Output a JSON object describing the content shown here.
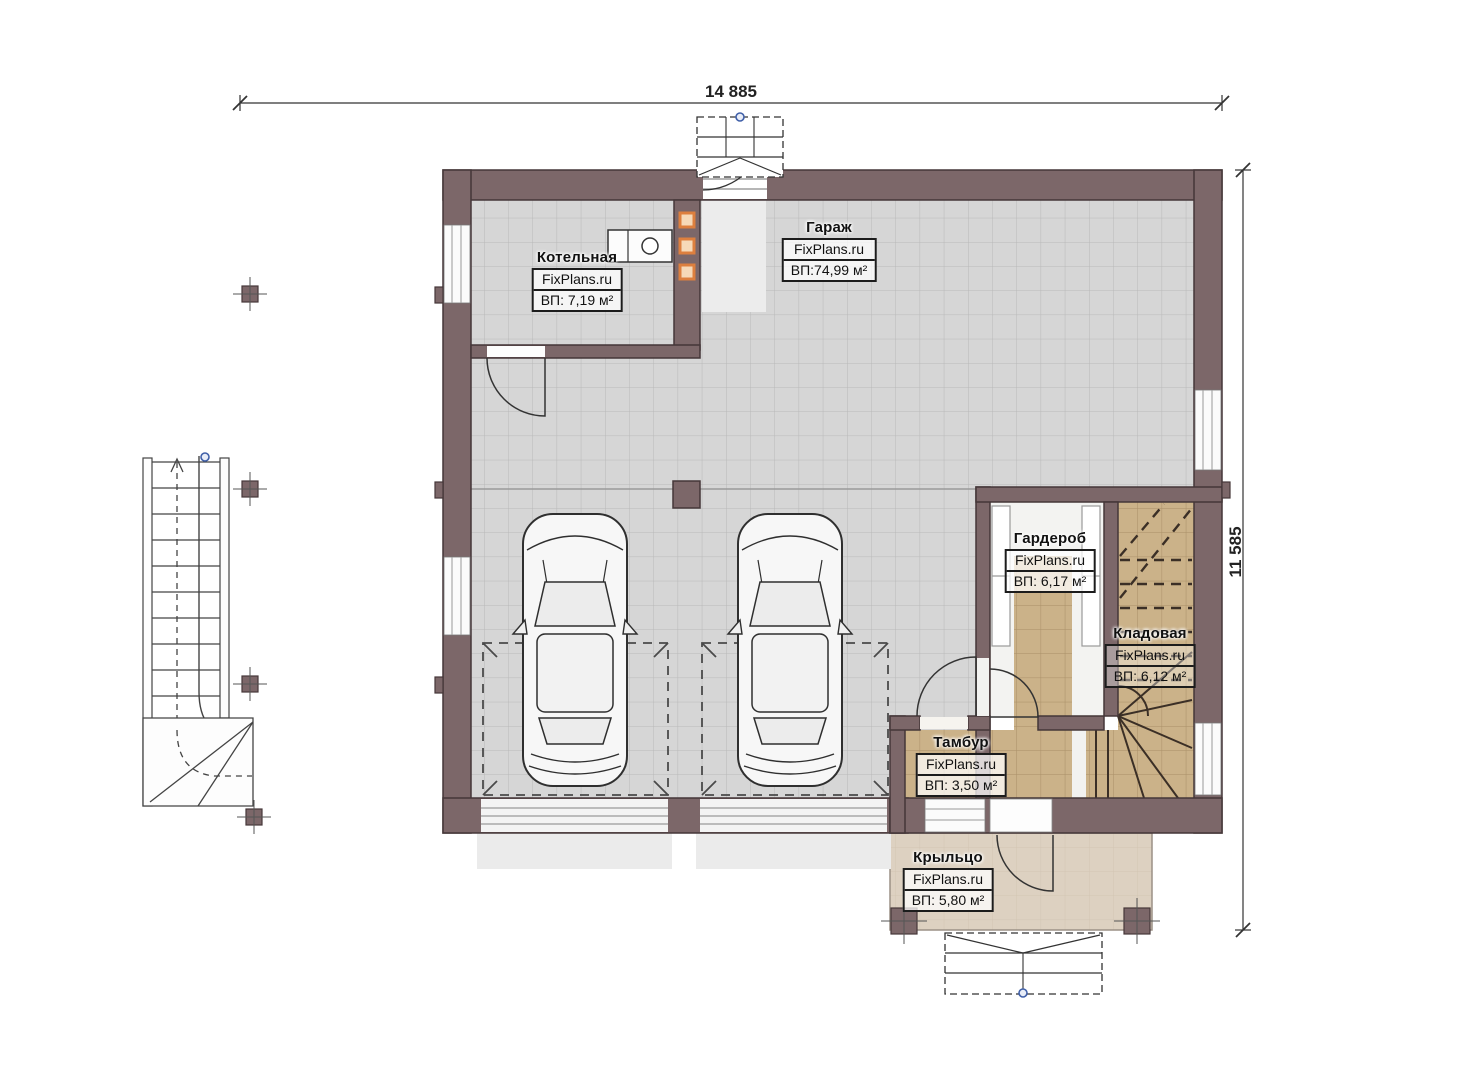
{
  "drawing": {
    "type": "floor-plan",
    "floor": "ground floor with garage",
    "watermark": "FixPlans.ru"
  },
  "dimensions": {
    "width_label": "14 885",
    "height_label": "11 585"
  },
  "rooms": [
    {
      "id": "garage",
      "name": "Гараж",
      "brand": "FixPlans.ru",
      "area": "ВП:74,99 м²"
    },
    {
      "id": "boiler",
      "name": "Котельная",
      "brand": "FixPlans.ru",
      "area": "ВП: 7,19 м²"
    },
    {
      "id": "wardrobe",
      "name": "Гардероб",
      "brand": "FixPlans.ru",
      "area": "ВП: 6,17 м²"
    },
    {
      "id": "storage",
      "name": "Кладовая",
      "brand": "FixPlans.ru",
      "area": "ВП: 6,12 м²"
    },
    {
      "id": "vestibule",
      "name": "Тамбур",
      "brand": "FixPlans.ru",
      "area": "ВП: 3,50 м²"
    },
    {
      "id": "porch",
      "name": "Крыльцо",
      "brand": "FixPlans.ru",
      "area": "ВП: 5,80 м²"
    }
  ],
  "palette": {
    "wall": "#7c6769",
    "wall_stroke": "#453739",
    "garage_floor": "#d6d6d6",
    "garage_grid": "#b9b9b9",
    "tile_floor": "#cbb289",
    "tile_grid": "#a98f67",
    "porch_floor": "#ddd1c1",
    "apron": "#ebebeb",
    "lines": "#333333",
    "vent_orange": "#dd7f3e",
    "marker_blue": "#3f5fa8"
  }
}
